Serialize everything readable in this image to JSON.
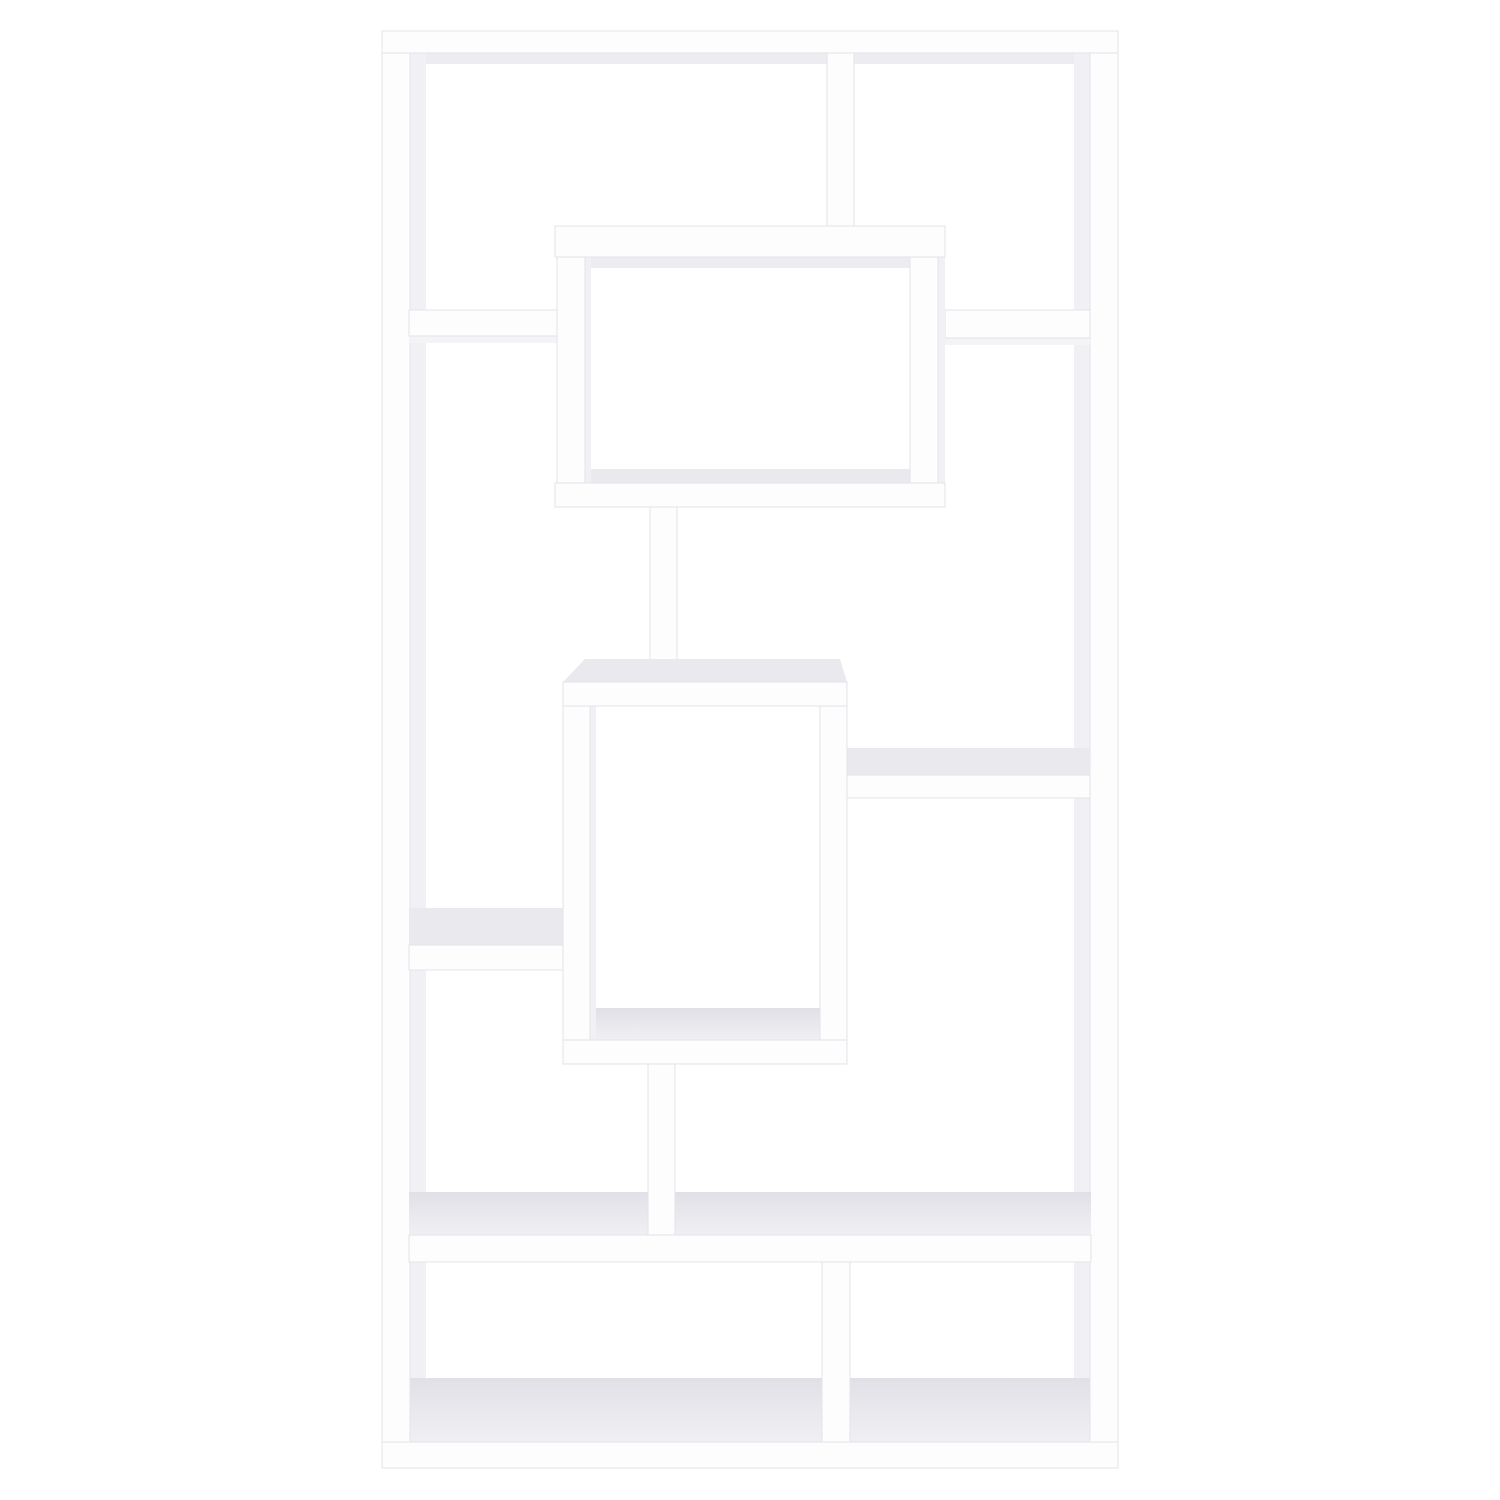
{
  "scene": {
    "title": "White geometric cube bookcase photographed front-on against a plain white background",
    "object": "geometric-bookcase",
    "finish": "white",
    "background_color": "#ffffff",
    "colors": {
      "bg": "#ffffff",
      "board": "#fdfdfe",
      "edge": "#e4e4e9",
      "underside": "#ededf1",
      "bevel": "#f1f1f5",
      "surface": "#e9e9ee",
      "surface_light": "#f0f0f4",
      "surface_deep": "#e0e0e6",
      "shadow": "#f4f4f7"
    }
  }
}
